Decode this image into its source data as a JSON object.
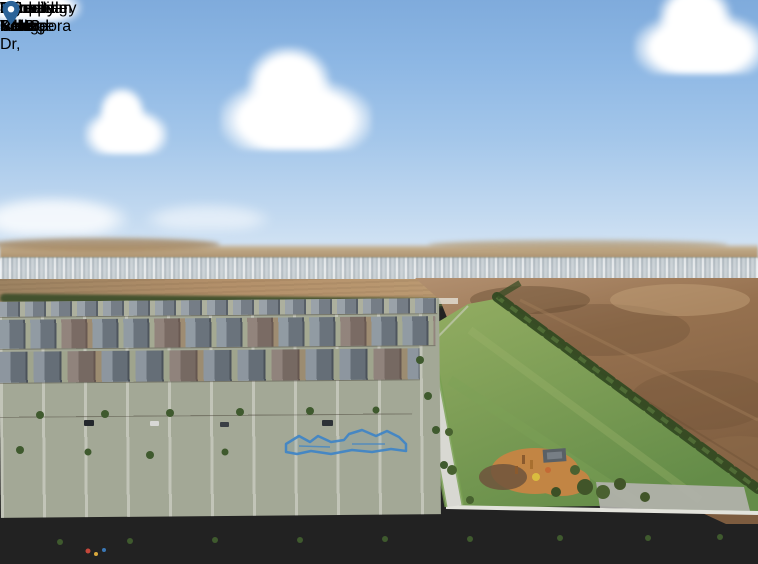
{
  "image": {
    "width": 758,
    "height": 564,
    "description": "Aerial drone photograph of a new residential estate with location callout labels for nearby schools, shopping centre and the subject property"
  },
  "colors": {
    "card_blue": "#2b6398",
    "info_strip_bg": "#f3f3f0",
    "info_text": "#1c2a38",
    "highlight_outline": "#4286c6",
    "leader_line": "#ffffff"
  },
  "property_callout": {
    "line1": "11 Micropora Dr,",
    "line2": "Wyndham Vale",
    "icon": "location-pin"
  },
  "callouts": [
    {
      "line1": "Brinbeal",
      "line2": "Secondary College",
      "mins": "8 MINS",
      "kms": "2.5 KMS",
      "icon": "graduation-cap"
    },
    {
      "line1": "Karwan",
      "line2": "Primary School",
      "mins": "8 MINS",
      "kms": "2.6 KMS",
      "icon": "graduation-cap"
    },
    {
      "line1": "Riverdale Village",
      "line2": "Shopping Centre",
      "mins": "16 MINS",
      "kms": "5.2 KMS",
      "icon": "shopping-cart"
    },
    {
      "line1": "Tarneit Rise",
      "line2": "Primary School",
      "mins": "18 MINS",
      "kms": "6.3 KMS",
      "icon": "graduation-cap"
    }
  ]
}
